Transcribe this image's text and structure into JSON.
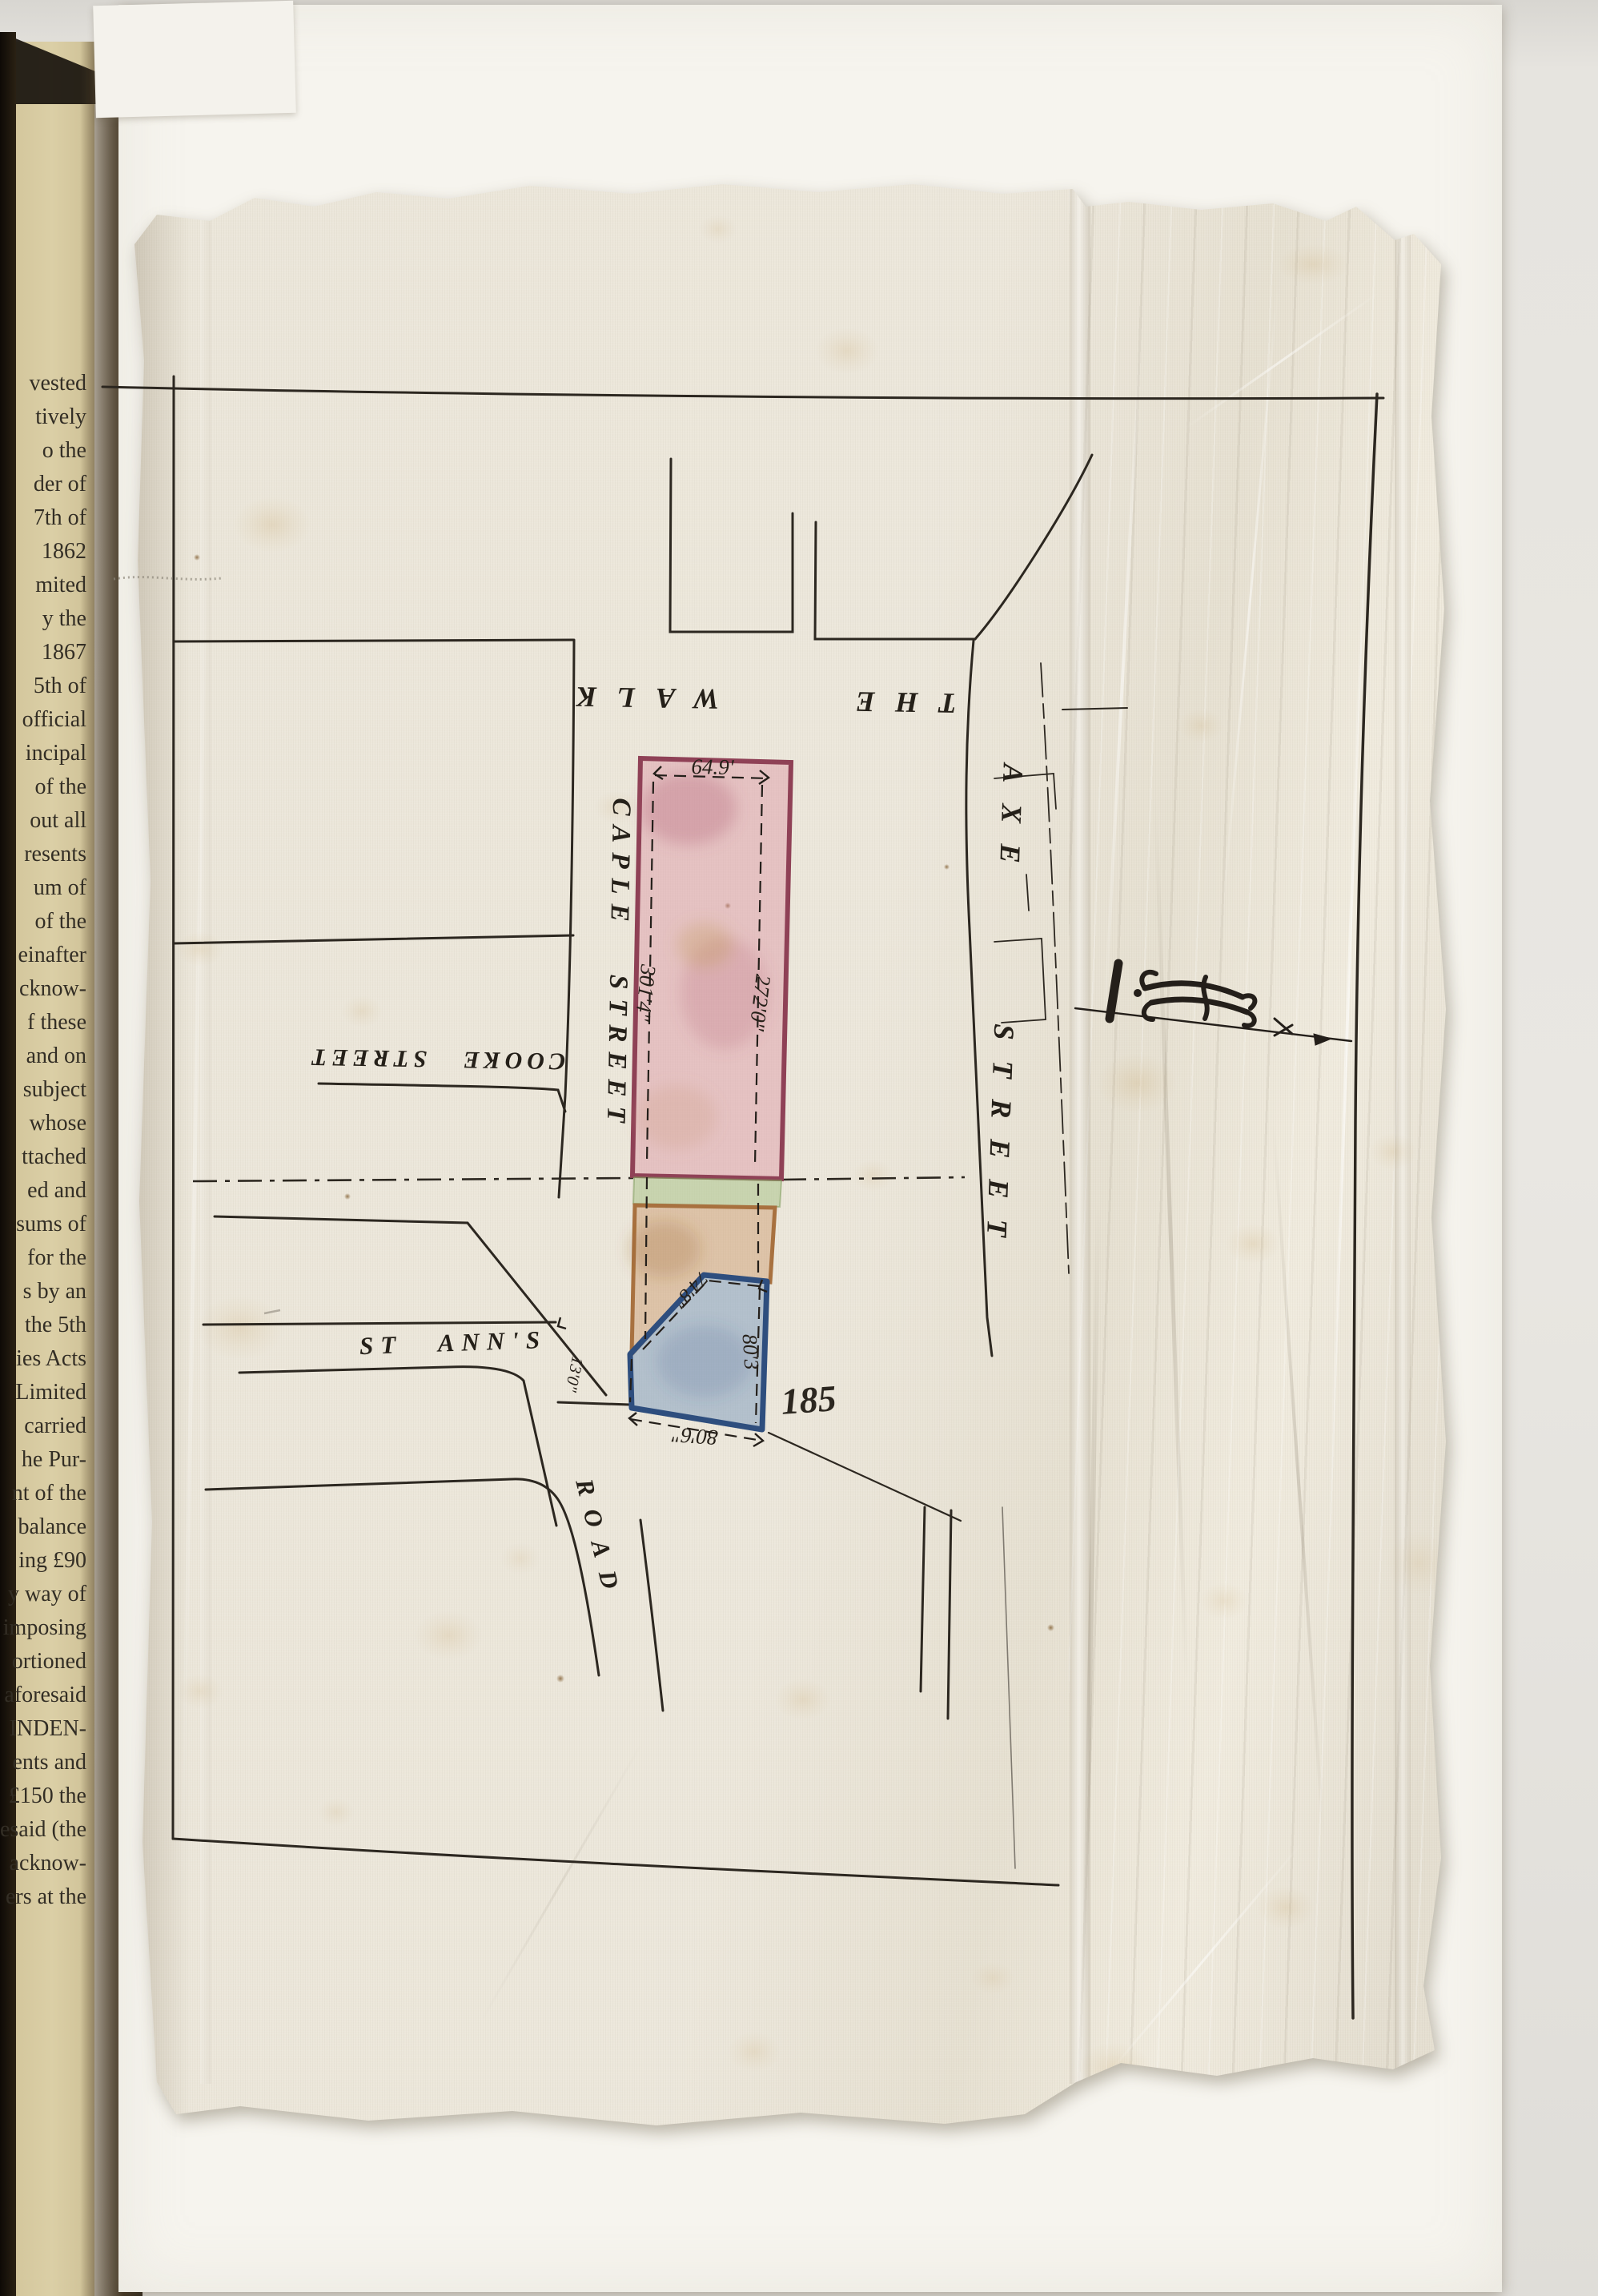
{
  "book_page": {
    "fragments": [
      "vested",
      "tively",
      "o the",
      "der of",
      "7th of",
      "1862",
      "mited",
      "y the",
      "1867",
      "5th of",
      "official",
      "incipal",
      "of the",
      "out all",
      "resents",
      "um of",
      "of the",
      "einafter",
      "cknow-",
      "f these",
      "and on",
      "subject",
      "whose",
      "ttached",
      "ed and",
      "sums of",
      "for the",
      "s by an",
      "the 5th",
      "ies Acts",
      "Limited",
      "carried",
      "he Pur-",
      "nt of the",
      "balance",
      "ing £90",
      "y way of",
      "imposing",
      "ortioned",
      "aforesaid",
      "INDEN-",
      "ents and",
      "£150 the",
      "esaid (the",
      "acknow-",
      "ers at the"
    ]
  },
  "plan": {
    "street_labels": {
      "the_walk": "THE WALK",
      "caple_street": "CAPLE STREET",
      "cooke_street": "COOKE STREET",
      "axe_street": "AXE STREET",
      "st_anns": "ST ANN'S",
      "road": "ROAD"
    },
    "dimensions": {
      "top": "64.9'",
      "west": "301'4\"",
      "east": "272'0\"",
      "diagonal": "74'8\"",
      "blue_east": "80'3",
      "blue_south": "80'6\"",
      "blue_west": "13'0\""
    },
    "plot_number": "185",
    "colors": {
      "ink": "#2c2720",
      "plot_pink_outline": "#8f4156",
      "plot_pink_fill": "#e0b4c0",
      "plot_green_fill": "#b7cc9d",
      "plot_tan_outline": "#a8713f",
      "plot_tan_fill": "#d6ab80",
      "plot_blue_outline": "#2e4e7e",
      "plot_blue_fill": "#a3bad4"
    }
  }
}
